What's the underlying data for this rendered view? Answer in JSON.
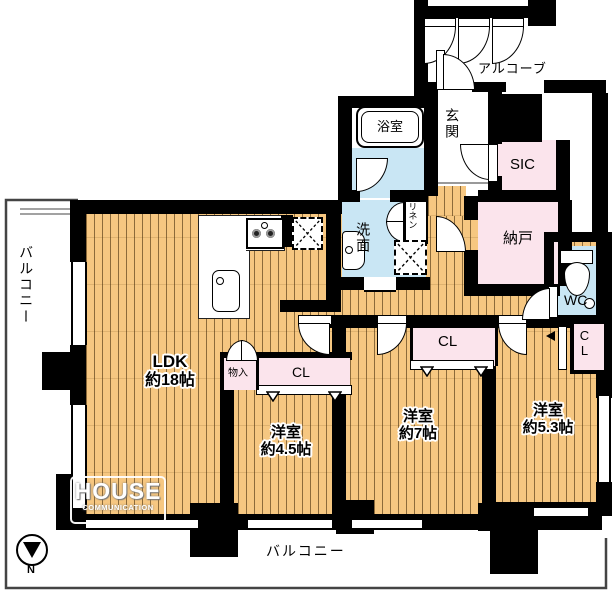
{
  "colors": {
    "wood_floor": "#F6C781",
    "closet_pink": "#FBE4EC",
    "wet_area_blue": "#C9E6F4",
    "wall_black": "#000000",
    "balcony_outline": "#444444"
  },
  "balconies": {
    "left": "バルコニー",
    "bottom": "バルコニー"
  },
  "alcove_label": "アルコーブ",
  "rooms": {
    "ldk": {
      "name": "LDK",
      "size": "約18帖"
    },
    "bedroom_45": {
      "name": "洋室",
      "size": "約4.5帖"
    },
    "bedroom_7": {
      "name": "洋室",
      "size": "約7帖"
    },
    "bedroom_53": {
      "name": "洋室",
      "size": "約5.3帖"
    },
    "bath": "浴室",
    "entrance": "玄関",
    "sic": "SIC",
    "storage_room": "納戸",
    "washroom": "洗面",
    "linen": "リネン",
    "wc": "WC",
    "closet_hall": "CL",
    "closet_45": "CL",
    "closet_53": "CL",
    "storage_box": "物入"
  },
  "watermark": {
    "line1": "HOUSE",
    "line2": "COMMUNICATION"
  },
  "compass_label": "N"
}
